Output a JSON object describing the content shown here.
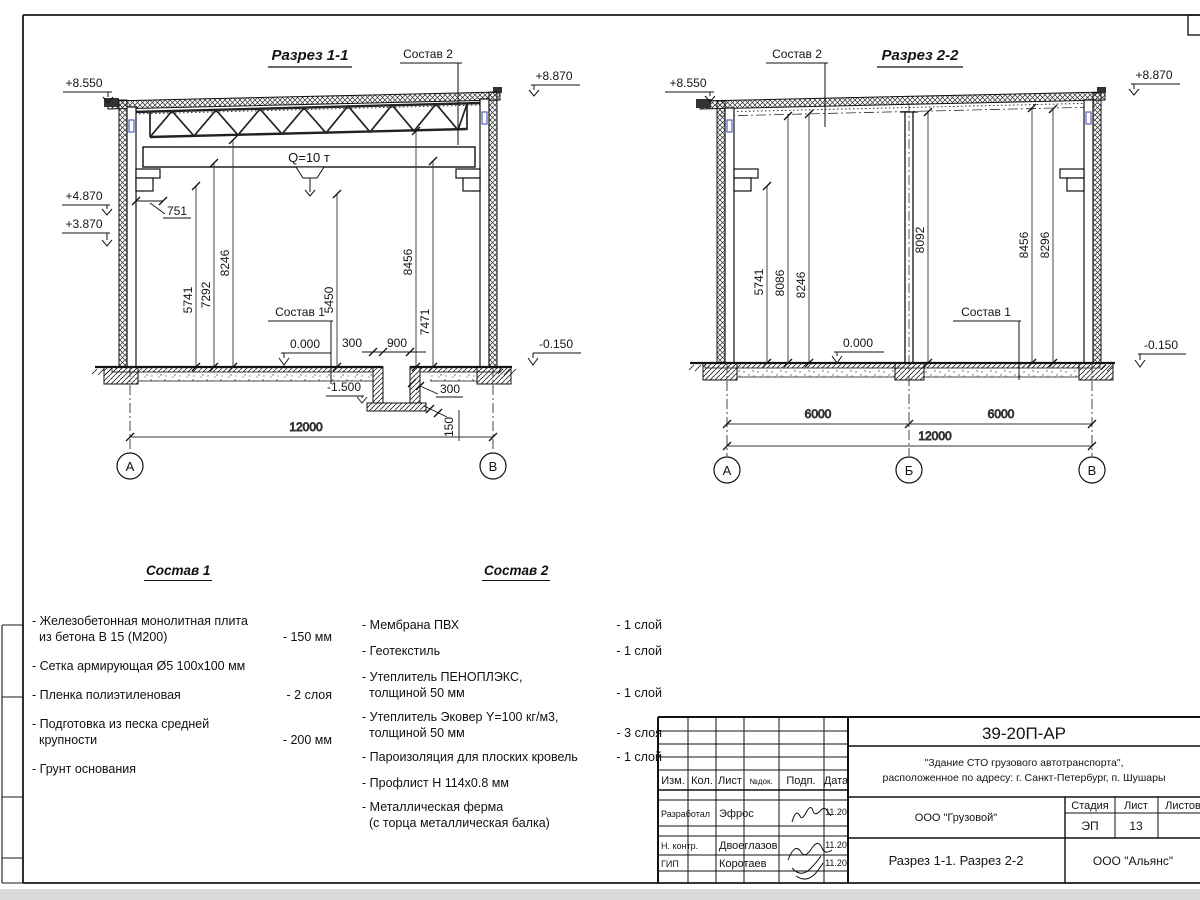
{
  "s1": {
    "title": "Разрез 1-1",
    "sostav2_label": "Состав 2",
    "sostav1_label": "Состав 1",
    "crane": "Q=10 т",
    "elev_top_left": "+8.550",
    "elev_top_right": "+8.870",
    "elev_mid": "+4.870",
    "elev_low": "+3.870",
    "zero": "0.000",
    "minus": "-0.150",
    "pit_depth": "-1.500",
    "dim751": "751",
    "vdims": [
      "5741",
      "7292",
      "8246",
      "5450",
      "8456",
      "7471"
    ],
    "pit_300l": "300",
    "pit_900": "900",
    "pit_300r": "300",
    "pit_150": "150",
    "width": "12000",
    "axis_a": "А",
    "axis_b": "В"
  },
  "s2": {
    "title": "Разрез 2-2",
    "sostav2_label": "Состав 2",
    "sostav1_label": "Состав 1",
    "elev_top_left": "+8.550",
    "elev_top_right": "+8.870",
    "zero": "0.000",
    "minus": "-0.150",
    "vdims": [
      "5741",
      "8086",
      "8246",
      "8092",
      "8456",
      "8296"
    ],
    "span1": "6000",
    "span2": "6000",
    "width": "12000",
    "axis_a": "А",
    "axis_b": "Б",
    "axis_c": "В"
  },
  "sostav1": {
    "title": "Состав 1",
    "items": [
      {
        "l1": "- Железобетонная  монолитная плита",
        "l2": "из бетона В 15 (М200)",
        "qty": "- 150 мм"
      },
      {
        "l1": "- Сетка армирующая Ø5 100х100 мм",
        "l2": "",
        "qty": ""
      },
      {
        "l1": "- Пленка полиэтиленовая",
        "l2": "",
        "qty": "-  2 слоя"
      },
      {
        "l1": "- Подготовка из песка средней",
        "l2": "крупности",
        "qty": "- 200 мм"
      },
      {
        "l1": "- Грунт основания",
        "l2": "",
        "qty": ""
      }
    ]
  },
  "sostav2": {
    "title": "Состав 2",
    "items": [
      {
        "l1": "- Мембрана ПВХ",
        "l2": "",
        "qty": "- 1 слой"
      },
      {
        "l1": "- Геотекстиль",
        "l2": "",
        "qty": "- 1 слой"
      },
      {
        "l1": "- Утеплитель ПЕНОПЛЭКС,",
        "l2": "толщиной 50 мм",
        "qty": "- 1 слой"
      },
      {
        "l1": "- Утеплитель Эковер Y=100 кг/м3,",
        "l2": "толщиной 50 мм",
        "qty": "- 3 слоя"
      },
      {
        "l1": "- Пароизоляция для плоских кровель",
        "l2": "",
        "qty": "- 1 слой"
      },
      {
        "l1": "- Профлист Н 114х0.8 мм",
        "l2": "",
        "qty": ""
      },
      {
        "l1": "- Металлическая ферма",
        "l2": "(с торца металлическая балка)",
        "qty": ""
      }
    ]
  },
  "titleblock": {
    "doc": "39-20П-АР",
    "obj1": "\"Здание СТО грузового автотранспорта\",",
    "obj2": "расположенное по адресу: г. Санкт-Петербург, п. Шушары",
    "cols": [
      "Изм.",
      "Кол.",
      "Лист",
      "№док.",
      "Подп.",
      "Дата"
    ],
    "rows": [
      {
        "role": "Разработал",
        "name": "Эфрос",
        "date": "11.20"
      },
      {
        "role": "Н. контр.",
        "name": "Двоеглазов",
        "date": "11.20"
      },
      {
        "role": "ГИП",
        "name": "Коротаев",
        "date": "11.20"
      }
    ],
    "client": "ООО \"Грузовой\"",
    "stage_label": "Стадия",
    "list_label": "Лист",
    "listov_label": "Листов",
    "stage": "ЭП",
    "sheet_no": "13",
    "drawing_title": "Разрез 1-1. Разрез 2-2",
    "company": "ООО \"Альянс\""
  }
}
